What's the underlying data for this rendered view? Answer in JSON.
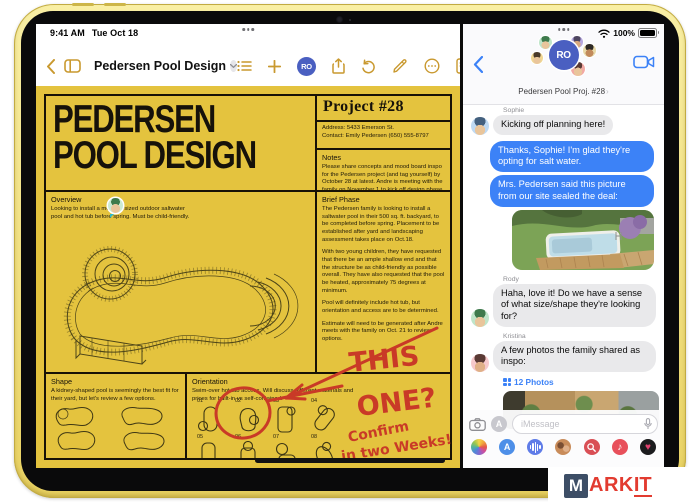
{
  "status_bar": {
    "time": "9:41 AM",
    "date": "Tue Oct 18",
    "battery_pct": "100%"
  },
  "pages_app": {
    "nav": {
      "title": "Pedersen Pool Design",
      "collab_badge": "RO"
    },
    "poster": {
      "title_line1": "PEDERSEN",
      "title_line2": "POOL DESIGN",
      "project_heading": "Project #28",
      "address_line": "Address: 5433 Emerson St.",
      "contact_line": "Contact: Emily Pedersen (650) 555-8797",
      "notes_heading": "Notes",
      "notes_body": "Please share concepts and mood board inspo for the Pedersen project (and tag yourself) by October 28 at latest. Andre is meeting with the family on November 1 to kick off design phase.",
      "overview_heading": "Overview",
      "overview_body": "Looking to install a medium-sized outdoor saltwater pool and hot tub before spring. Must be child-friendly.",
      "brief_heading": "Brief Phase",
      "brief_para1": "The Pedersen family is looking to install a saltwater pool in their 500 sq. ft. backyard, to be completed before spring. Placement to be established after yard and landscaping assessment takes place on Oct.18.",
      "brief_para2": "With two young children, they have requested that there be an ample shallow end and that the structure be as child-friendly as possible overall. They have also requested that the pool be heated, approximately 75 degrees at minimum.",
      "brief_para3": "Pool will definitely include hot tub, but orientation and access are to be determined.",
      "brief_para4": "Estimate will need to be generated after Andre meets with the family on Oct. 21 to review options.",
      "shape_heading": "Shape",
      "shape_body": "A kidney-shaped pool is seemingly the best fit for their yard, but let's review a few options.",
      "orientation_heading": "Orientation",
      "orientation_body": "Swim-over hot tub access. Will discuss different materials and prices for built-in vs self-contained.",
      "options_row1": [
        "01",
        "02",
        "03",
        "04"
      ],
      "options_row2": [
        "05",
        "06",
        "07",
        "08"
      ],
      "annotation_line1": "THIS",
      "annotation_line2": "ONE?",
      "annotation_line3": "Confirm",
      "annotation_line4": "in two Weeks!"
    }
  },
  "messages_app": {
    "header": {
      "title": "Pedersen Pool Proj. #28",
      "chevron": "›",
      "group_badge": "RO"
    },
    "chat": {
      "sophie_label": "Sophie",
      "sophie_msg": "Kicking off planning here!",
      "reply1": "Thanks, Sophie! I'm glad they're opting for salt water.",
      "reply2": "Mrs. Pedersen said this picture from our site sealed the deal:",
      "rody_label": "Rody",
      "rody_msg": "Haha, love it! Do we have a sense of what size/shape they're looking for?",
      "kristina_label": "Kristina",
      "kristina_msg": "A few photos the family shared as inspo:",
      "photos_link": "12 Photos"
    },
    "composer": {
      "placeholder": "iMessage"
    }
  },
  "watermark": {
    "m": "M",
    "ark": "ARK",
    "it": "IT"
  },
  "colors": {
    "poster_yellow": "#E4C33E",
    "accent_gold": "#C9992F",
    "imessage_blue": "#3C82F7",
    "bubble_gray": "#E9E9EB",
    "annotation_red": "#C93A27",
    "collab_blue": "#4A5FC1"
  }
}
